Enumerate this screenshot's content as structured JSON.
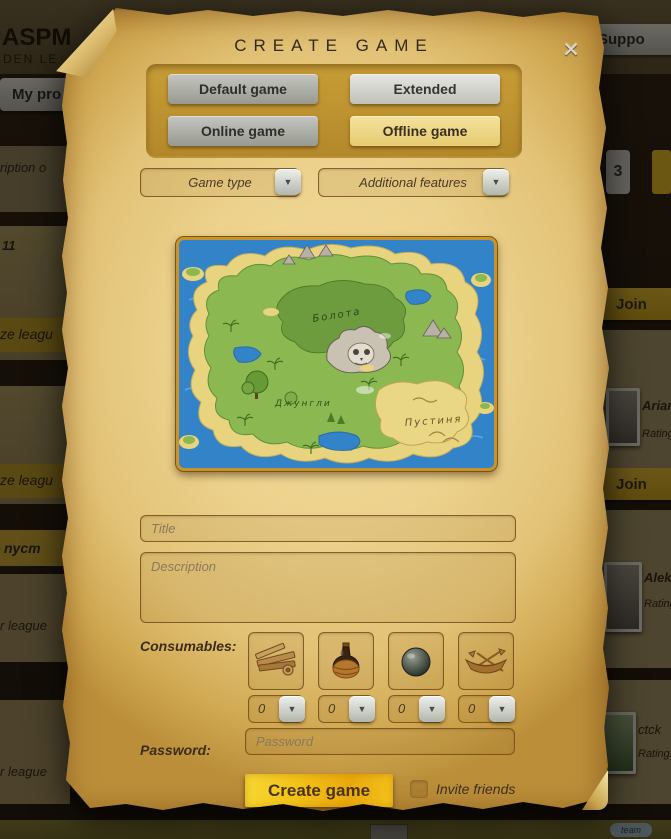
{
  "background": {
    "logo_line1": "ASPM",
    "logo_line2": "DEN LE",
    "my_profile_tab": "My pro",
    "support_tab": "Suppo",
    "badge_count": "3",
    "left_fragments": [
      "ription o",
      "11",
      "ze leagu",
      "ze leagu",
      "nycm",
      "r league",
      "r league"
    ],
    "join_label": "Join",
    "players": [
      {
        "name": "Ariana",
        "rating_label": "Rating:"
      },
      {
        "name": "Aleksa",
        "rating_label": "Rating:"
      },
      {
        "name": "ctck",
        "rating_label": "Rating:"
      }
    ],
    "bottom_chip": "team"
  },
  "dialog": {
    "title": "CREATE GAME",
    "close_icon": "✕",
    "mode_buttons": [
      {
        "label": "Default game",
        "selected": false
      },
      {
        "label": "Extended",
        "selected": false
      },
      {
        "label": "Online game",
        "selected": false
      },
      {
        "label": "Offline game",
        "selected": true
      }
    ],
    "dropdowns": [
      {
        "label": "Game type"
      },
      {
        "label": "Additional features"
      }
    ],
    "map_regions": [
      "Болота",
      "Джунгли",
      "Пустиня"
    ],
    "title_placeholder": "Title",
    "description_placeholder": "Description",
    "consumables_label": "Consumables:",
    "consumables": [
      {
        "name": "planks",
        "qty": "0"
      },
      {
        "name": "bottle",
        "qty": "0"
      },
      {
        "name": "cannonball",
        "qty": "0"
      },
      {
        "name": "boat",
        "qty": "0"
      }
    ],
    "password_label": "Password:",
    "password_placeholder": "Password",
    "create_button": "Create game",
    "invite_friends_label": "Invite friends",
    "invite_checked": false
  },
  "icons": {
    "dropdown_arrow": "▼"
  },
  "colors": {
    "parchment": "#ecd28d",
    "panel_gold": "#bb8f2b",
    "selected_yellow": "#eedc8e",
    "accent_gold": "#f0bd14",
    "steel": "#b9bcb4",
    "map_water": "#3383c8",
    "map_green": "#8cb852",
    "map_sand": "#e8d47e"
  }
}
